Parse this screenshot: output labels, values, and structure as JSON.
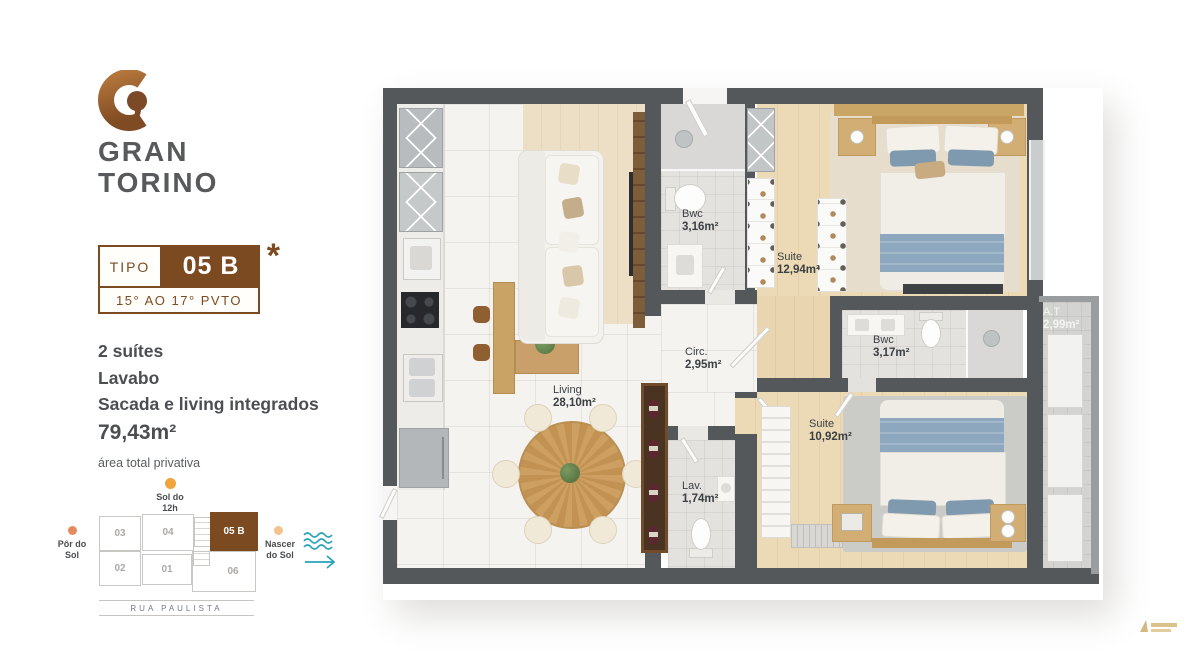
{
  "brand": {
    "line1": "GRAN",
    "line2": "TORINO"
  },
  "badge": {
    "tipo": "TIPO",
    "unit": "05 B",
    "asterisk": "*",
    "floors": "15° AO 17° PVTO"
  },
  "features": {
    "items": [
      "2 suítes",
      "Lavabo",
      "Sacada e living integrados"
    ],
    "area": "79,43m²",
    "note": "área total privativa"
  },
  "minimap": {
    "sun_noon": {
      "l1": "Sol do",
      "l2": "12h"
    },
    "sunset": {
      "l1": "Pôr do",
      "l2": "Sol"
    },
    "sunrise": {
      "l1": "Nascer",
      "l2": "do Sol"
    },
    "street": "RUA PAULISTA",
    "units": [
      {
        "id": "03"
      },
      {
        "id": "04"
      },
      {
        "id": "05 B"
      },
      {
        "id": "02"
      },
      {
        "id": "01"
      },
      {
        "id": "06"
      }
    ]
  },
  "floorplan": {
    "rooms": [
      {
        "name": "Bwc",
        "area": "3,16m²"
      },
      {
        "name": "Suite",
        "area": "12,94m²"
      },
      {
        "name": "Circ.",
        "area": "2,95m²"
      },
      {
        "name": "Bwc",
        "area": "3,17m²"
      },
      {
        "name": "A.T",
        "area": "2,99m²"
      },
      {
        "name": "Living",
        "area": "28,10m²"
      },
      {
        "name": "Suite",
        "area": "10,92m²"
      },
      {
        "name": "Lav.",
        "area": "1,74m²"
      }
    ]
  },
  "colors": {
    "accent": "#7c4a21",
    "wall": "#55585a",
    "teal": "#2aa3b8",
    "sun": "#f1a33c"
  }
}
